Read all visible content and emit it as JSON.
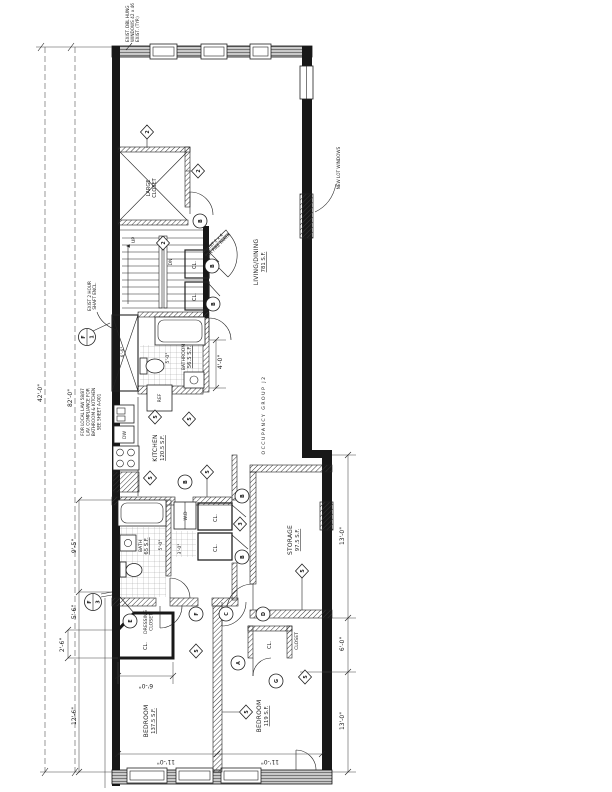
{
  "notes": {
    "window_note": [
      "EXIST. DBL HUNG",
      "WINDOWS 42 x 46",
      "EXIST. (TYP.)"
    ],
    "lot_window_note": "NEW LOT WINDOWS",
    "shaft_note": [
      "EXIST 2 HOUR",
      "SHAFT ENCL."
    ],
    "local_law_note": [
      "FOR LOCAL LAW 58/87",
      "LAV. COMPLIANCE FOR",
      "BATHROOM & KITCHEN",
      "SEE SHEET A-001"
    ],
    "entry_note": [
      "EXIST 2 x 4",
      "1 HR FIRE PARTN"
    ]
  },
  "rooms": {
    "large_closet": [
      "LARGE",
      "CLOSET"
    ],
    "living": {
      "name": "LIVING/DINING",
      "area": "781 S.F."
    },
    "occupancy": "OCCUPANCY GROUP J2",
    "bathroom": {
      "name": "BATHROOM",
      "area": "56.5 S.F."
    },
    "kitchen": {
      "name": "KITCHEN",
      "area": "120.5 S.F."
    },
    "bath": {
      "name": "BATH",
      "area": "65 S.F."
    },
    "storage": {
      "name": "STORAGE",
      "area": "97.5 S.F."
    },
    "dressing_closet": [
      "DRESSING",
      "CLOSET"
    ],
    "closet": "CLOSET",
    "bedroom1": {
      "name": "BEDROOM",
      "area": "137.5 S.F."
    },
    "bedroom2": {
      "name": "BEDROOM",
      "area": "119 S.F."
    },
    "cl": "CL.",
    "wd": "W.D",
    "ref": "REF",
    "dw": "DW",
    "up": "UP",
    "dn": "DN"
  },
  "dimensions": {
    "overall_a": "42'-0\"",
    "overall_b": "82'-0\"",
    "left_chain": [
      "9'-5\"",
      "5'-6\"",
      "2'-6\"",
      "12'-6\""
    ],
    "right_chain": [
      "13'-0\"",
      "6'-0\"",
      "13'-0\""
    ],
    "bedroom1_width": "11'-0\"",
    "bedroom2_width": "11'-0\"",
    "closet_width": "6'-0\"",
    "bath_width": "4'-0\"",
    "bath_inner": "5'-0\"",
    "hall_a": "5'-0\"",
    "hall_b": "3'-0\"",
    "shaft_width": "6'-6\""
  },
  "tags": {
    "diamonds": [
      {
        "label": "2"
      },
      {
        "label": "2"
      },
      {
        "label": "2"
      },
      {
        "label": "5"
      },
      {
        "label": "5"
      },
      {
        "label": "5"
      },
      {
        "label": "5"
      },
      {
        "label": "3"
      },
      {
        "label": "5"
      },
      {
        "label": "5"
      },
      {
        "label": "5"
      },
      {
        "label": "5"
      }
    ],
    "doors": [
      {
        "label": "B"
      },
      {
        "label": "B"
      },
      {
        "label": "B"
      },
      {
        "label": "B"
      },
      {
        "label": "B"
      },
      {
        "label": "B"
      },
      {
        "label": "E"
      },
      {
        "label": "F"
      },
      {
        "label": "C"
      },
      {
        "label": "D"
      },
      {
        "label": "A"
      },
      {
        "label": "G"
      }
    ],
    "sections": [
      {
        "letter": "F",
        "number": "1"
      },
      {
        "letter": "F",
        "number": "3"
      }
    ]
  }
}
